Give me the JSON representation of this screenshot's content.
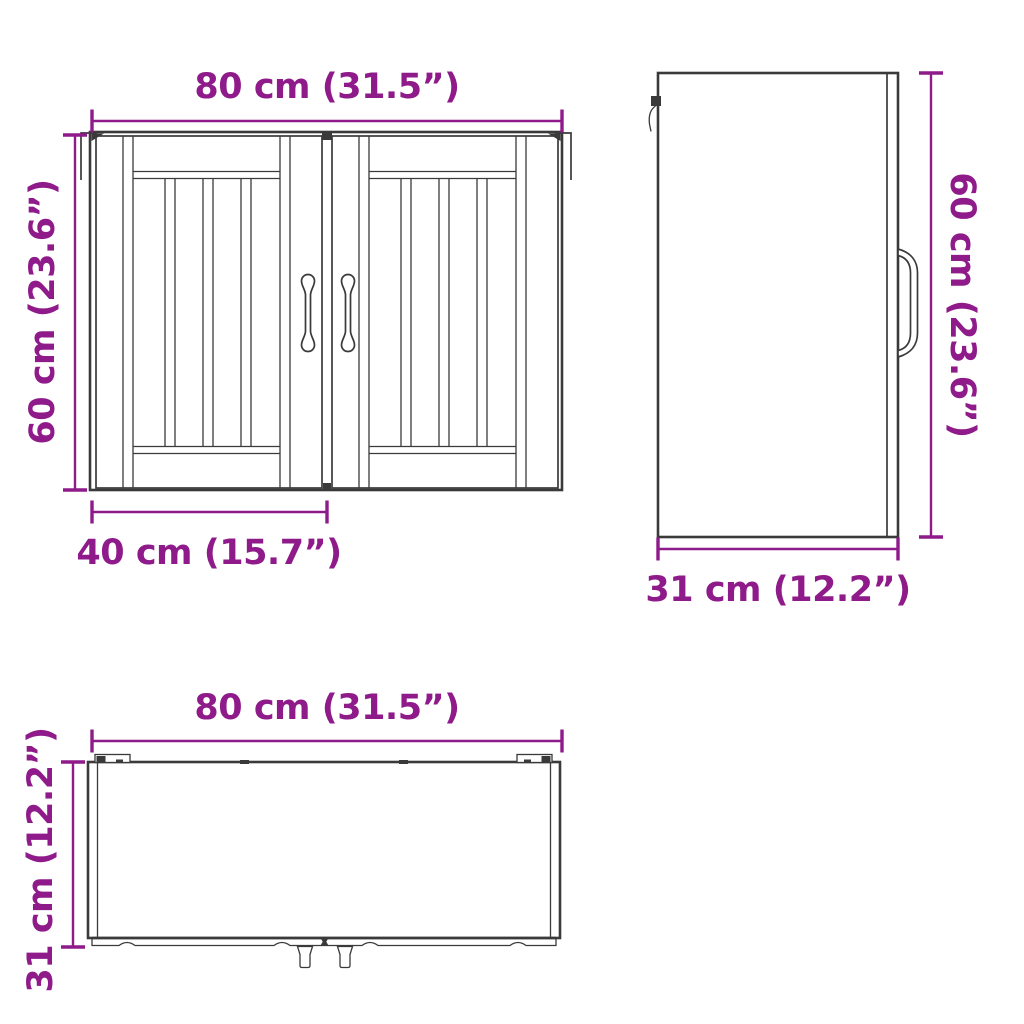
{
  "colors": {
    "accent": "#8f1a8a",
    "ink": "#3a3a3a",
    "background": "#ffffff"
  },
  "diagram": {
    "front": {
      "width_label": "80 cm (31.5”)",
      "height_label": "60 cm (23.6”)",
      "door_width_label": "40 cm (15.7”)"
    },
    "side": {
      "height_label": "60 cm (23.6”)",
      "depth_label": "31 cm (12.2”)"
    },
    "top": {
      "width_label": "80 cm (31.5”)",
      "depth_label": "31 cm (12.2”)"
    }
  }
}
